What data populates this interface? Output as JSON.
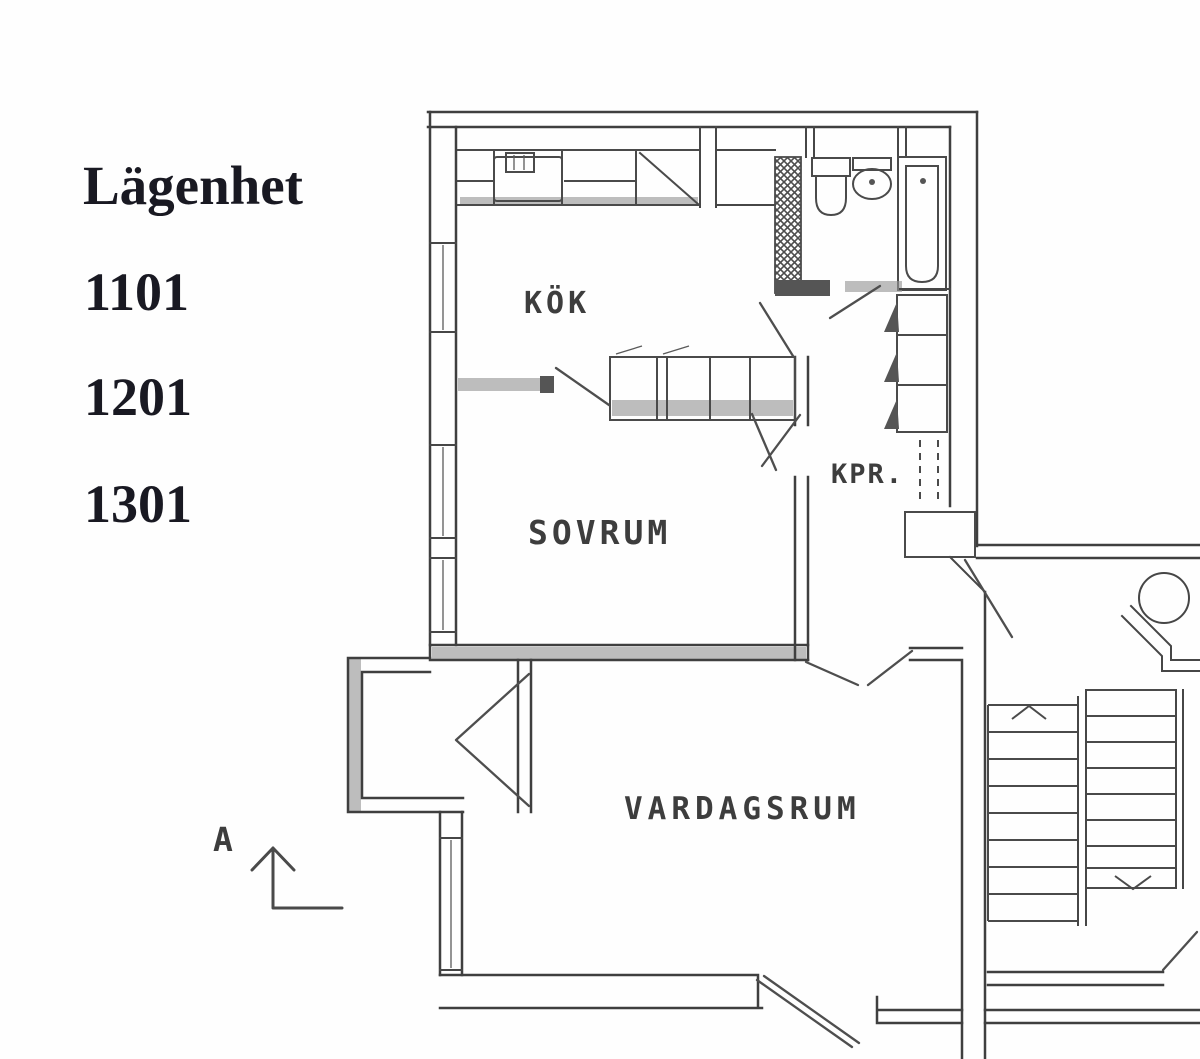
{
  "legend": {
    "title": "Lägenhet",
    "apartments": [
      "1101",
      "1201",
      "1301"
    ]
  },
  "floor_plan": {
    "rooms": [
      {
        "id": "kok",
        "label": "KÖK"
      },
      {
        "id": "sovrum",
        "label": "SOVRUM"
      },
      {
        "id": "kpr",
        "label": "KPR."
      },
      {
        "id": "vardagsrum",
        "label": "VARDAGSRUM"
      }
    ],
    "section_marker": {
      "label": "A"
    },
    "features": [
      "balcony",
      "stairwell",
      "garbage-chute",
      "bathtub",
      "toilet",
      "wash-basin",
      "kitchen-sink",
      "wardrobes",
      "vent-shaft"
    ],
    "colors": {
      "background": "#fefefe",
      "line": "#3f3f3f",
      "room_label": "#3d3d3d",
      "legend_text": "#191922",
      "wall_shading": "#949494"
    }
  }
}
